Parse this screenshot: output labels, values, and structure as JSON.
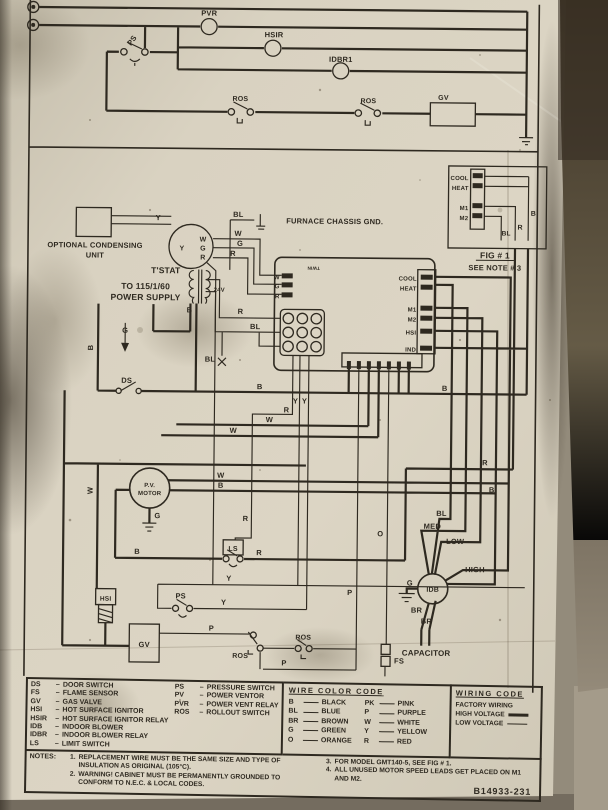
{
  "photo": {
    "paper_color": "#d8d1c0",
    "ink_color": "#2e2920",
    "wall_color": "#8f8778",
    "streak_color": "#4a4132"
  },
  "top_circuit": {
    "pvr": "PVR",
    "hsir": "HSIR",
    "idbr1": "IDBR1",
    "ps": "PS",
    "ros1": "ROS",
    "ros2": "ROS",
    "gv": "GV"
  },
  "main_circuit": {
    "optional_unit_line1": "OPTIONAL CONDENSING",
    "optional_unit_line2": "UNIT",
    "chassis_gnd": "FURNACE CHASSIS GND.",
    "tstat": "T'STAT",
    "tstat_y": "Y",
    "tstat_w": "W",
    "tstat_g": "G",
    "tstat_r": "R",
    "power_line1": "TO 115/1/60",
    "power_line2": "POWER SUPPLY",
    "transformer": "24V",
    "twin": "TWIN",
    "board_w": "W",
    "board_g": "G",
    "board_r": "R",
    "board_cool": "COOL",
    "board_heat": "HEAT",
    "board_m1": "M1",
    "board_m2": "M2",
    "board_hsi": "HSI",
    "board_ind": "IND",
    "ds": "DS",
    "pv_line1": "P.V.",
    "pv_line2": "MOTOR",
    "ls": "LS",
    "ps": "PS",
    "hsi": "HSI",
    "gv": "GV",
    "ros1": "ROS",
    "ros2": "ROS",
    "idb": "IDB",
    "med": "MED",
    "low": "LOW",
    "high": "HIGH",
    "capacitor": "CAPACITOR",
    "fs": "FS"
  },
  "fig1": {
    "cool": "COOL",
    "heat": "HEAT",
    "m1": "M1",
    "m2": "M2",
    "b": "B",
    "r": "R",
    "bl": "BL",
    "caption": "FIG # 1",
    "note": "SEE NOTE # 3"
  },
  "wire_labels": [
    {
      "t": "Y",
      "x": 160,
      "y": 219
    },
    {
      "t": "BL",
      "x": 240,
      "y": 215
    },
    {
      "t": "W",
      "x": 240,
      "y": 234
    },
    {
      "t": "G",
      "x": 242,
      "y": 244
    },
    {
      "t": "R",
      "x": 235,
      "y": 254
    },
    {
      "t": "B",
      "x": 192,
      "y": 311
    },
    {
      "t": "R",
      "x": 243,
      "y": 312
    },
    {
      "t": "BL",
      "x": 258,
      "y": 327
    },
    {
      "t": "BL",
      "x": 213,
      "y": 360
    },
    {
      "t": "B",
      "x": 96,
      "y": 347,
      "r": -90
    },
    {
      "t": "G",
      "x": 128,
      "y": 332
    },
    {
      "t": "B",
      "x": 263,
      "y": 387
    },
    {
      "t": "Y",
      "x": 299,
      "y": 401
    },
    {
      "t": "Y",
      "x": 308,
      "y": 401
    },
    {
      "t": "R",
      "x": 290,
      "y": 410
    },
    {
      "t": "W",
      "x": 273,
      "y": 420
    },
    {
      "t": "W",
      "x": 237,
      "y": 431
    },
    {
      "t": "B",
      "x": 448,
      "y": 387
    },
    {
      "t": "R",
      "x": 489,
      "y": 461
    },
    {
      "t": "B",
      "x": 496,
      "y": 488
    },
    {
      "t": "W",
      "x": 225,
      "y": 476
    },
    {
      "t": "B",
      "x": 225,
      "y": 486
    },
    {
      "t": "BL",
      "x": 446,
      "y": 512
    },
    {
      "t": "W",
      "x": 97,
      "y": 490,
      "r": -90
    },
    {
      "t": "R",
      "x": 250,
      "y": 519
    },
    {
      "t": "R",
      "x": 264,
      "y": 553
    },
    {
      "t": "B",
      "x": 142,
      "y": 553
    },
    {
      "t": "Y",
      "x": 234,
      "y": 579
    },
    {
      "t": "Y",
      "x": 229,
      "y": 603
    },
    {
      "t": "G",
      "x": 162,
      "y": 517
    },
    {
      "t": "P",
      "x": 217,
      "y": 629
    },
    {
      "t": "P",
      "x": 290,
      "y": 663
    },
    {
      "t": "P",
      "x": 355,
      "y": 592
    },
    {
      "t": "O",
      "x": 385,
      "y": 533
    },
    {
      "t": "BR",
      "x": 422,
      "y": 609
    },
    {
      "t": "BR",
      "x": 432,
      "y": 620
    },
    {
      "t": "G",
      "x": 415,
      "y": 582
    }
  ],
  "legend": {
    "sep": "–",
    "column1": [
      {
        "abbr": "DS",
        "name": "DOOR SWITCH"
      },
      {
        "abbr": "FS",
        "name": "FLAME SENSOR"
      },
      {
        "abbr": "GV",
        "name": "GAS VALVE"
      },
      {
        "abbr": "HSI",
        "name": "HOT SURFACE IGNITOR"
      },
      {
        "abbr": "HSIR",
        "name": "HOT SURFACE IGNITOR RELAY"
      },
      {
        "abbr": "IDB",
        "name": "INDOOR BLOWER"
      },
      {
        "abbr": "IDBR",
        "name": "INDOOR BLOWER RELAY"
      },
      {
        "abbr": "LS",
        "name": "LIMIT SWITCH"
      }
    ],
    "column2": [
      {
        "abbr": "PS",
        "name": "PRESSURE SWITCH"
      },
      {
        "abbr": "PV",
        "name": "POWER VENTOR"
      },
      {
        "abbr": "PVR",
        "name": "POWER VENT RELAY"
      },
      {
        "abbr": "ROS",
        "name": "ROLLOUT SWITCH"
      }
    ]
  },
  "wire_color_code": {
    "title": "WIRE COLOR CODE",
    "columns": [
      [
        {
          "abbr": "B",
          "name": "BLACK"
        },
        {
          "abbr": "BL",
          "name": "BLUE"
        },
        {
          "abbr": "BR",
          "name": "BROWN"
        },
        {
          "abbr": "G",
          "name": "GREEN"
        },
        {
          "abbr": "O",
          "name": "ORANGE"
        }
      ],
      [
        {
          "abbr": "PK",
          "name": "PINK"
        },
        {
          "abbr": "P",
          "name": "PURPLE"
        },
        {
          "abbr": "W",
          "name": "WHITE"
        },
        {
          "abbr": "Y",
          "name": "YELLOW"
        },
        {
          "abbr": "R",
          "name": "RED"
        }
      ]
    ]
  },
  "wiring_code": {
    "title": "WIRING CODE",
    "factory": "FACTORY WIRING",
    "high": "HIGH VOLTAGE",
    "low": "LOW VOLTAGE"
  },
  "notes": {
    "heading": "NOTES:",
    "items_left": [
      {
        "num": "1.",
        "text": "REPLACEMENT WIRE MUST BE THE SAME SIZE AND TYPE OF INSULATION AS ORIGINAL (105°C)."
      },
      {
        "num": "2.",
        "text": "WARNING! CABINET MUST BE PERMANENTLY GROUNDED TO CONFORM TO N.E.C. & LOCAL CODES."
      }
    ],
    "items_right": [
      {
        "num": "3.",
        "text": "FOR MODEL GMT140-5, SEE FIG # 1."
      },
      {
        "num": "4.",
        "text": "ALL UNUSED MOTOR SPEED LEADS GET PLACED ON M1 AND M2."
      }
    ]
  },
  "part_number": "B14933-231"
}
